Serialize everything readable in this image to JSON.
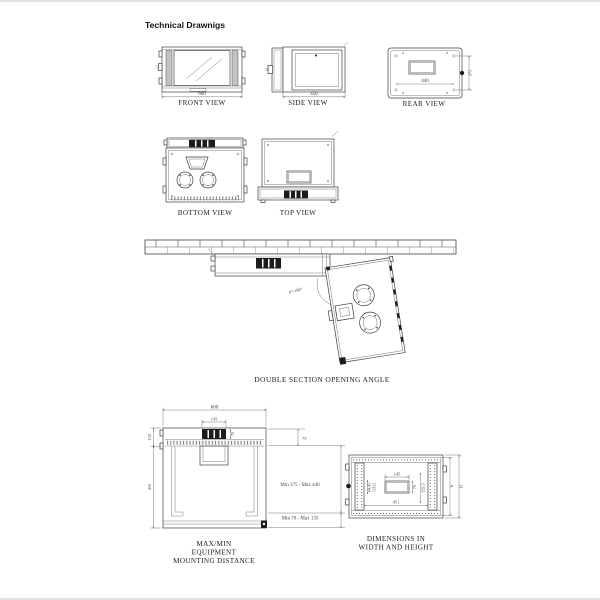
{
  "page": {
    "title": "Technical Drawnigs",
    "border_color": "#e2e2e2"
  },
  "views": {
    "front": {
      "label": "FRONT VIEW",
      "width_dim": "600"
    },
    "side": {
      "label": "SIDE VIEW",
      "depth_dim": "450"
    },
    "rear": {
      "label": "REAR VIEW",
      "hole_width_dim": "440",
      "hole_height_dim": "375"
    },
    "bottom": {
      "label": "BOTTOM VIEW"
    },
    "top": {
      "label": "TOP VIEW"
    }
  },
  "opening_diagram": {
    "label": "DOUBLE SECTION OPENING ANGLE",
    "angle_range": "0°-180°"
  },
  "mounting_diagram": {
    "caption_line1": "MAX/MIN",
    "caption_line2": "EQUIPMENT",
    "caption_line3": "MOUNTING DISTANCE",
    "dims": {
      "overall_width": "600",
      "vent_width": "145",
      "vent_depth": "70",
      "roof_height": "150",
      "body_height": "450",
      "top_clearance": "75",
      "equipment_range": "Min 375 - Max 440",
      "bottom_range": "Min 70 - Max 135"
    }
  },
  "dimensions_diagram": {
    "caption_line1": "DIMENSIONS IN",
    "caption_line2": "WIDTH AND HEIGHT",
    "dims": {
      "cutout_width": "145",
      "cutout_height": "70",
      "diagonal": "129.5",
      "rack_unit": "44.45",
      "rack_unit_label": "[1U]",
      "inner_width": "451",
      "inner_height_label": "h",
      "outer_height_label": "H"
    }
  }
}
